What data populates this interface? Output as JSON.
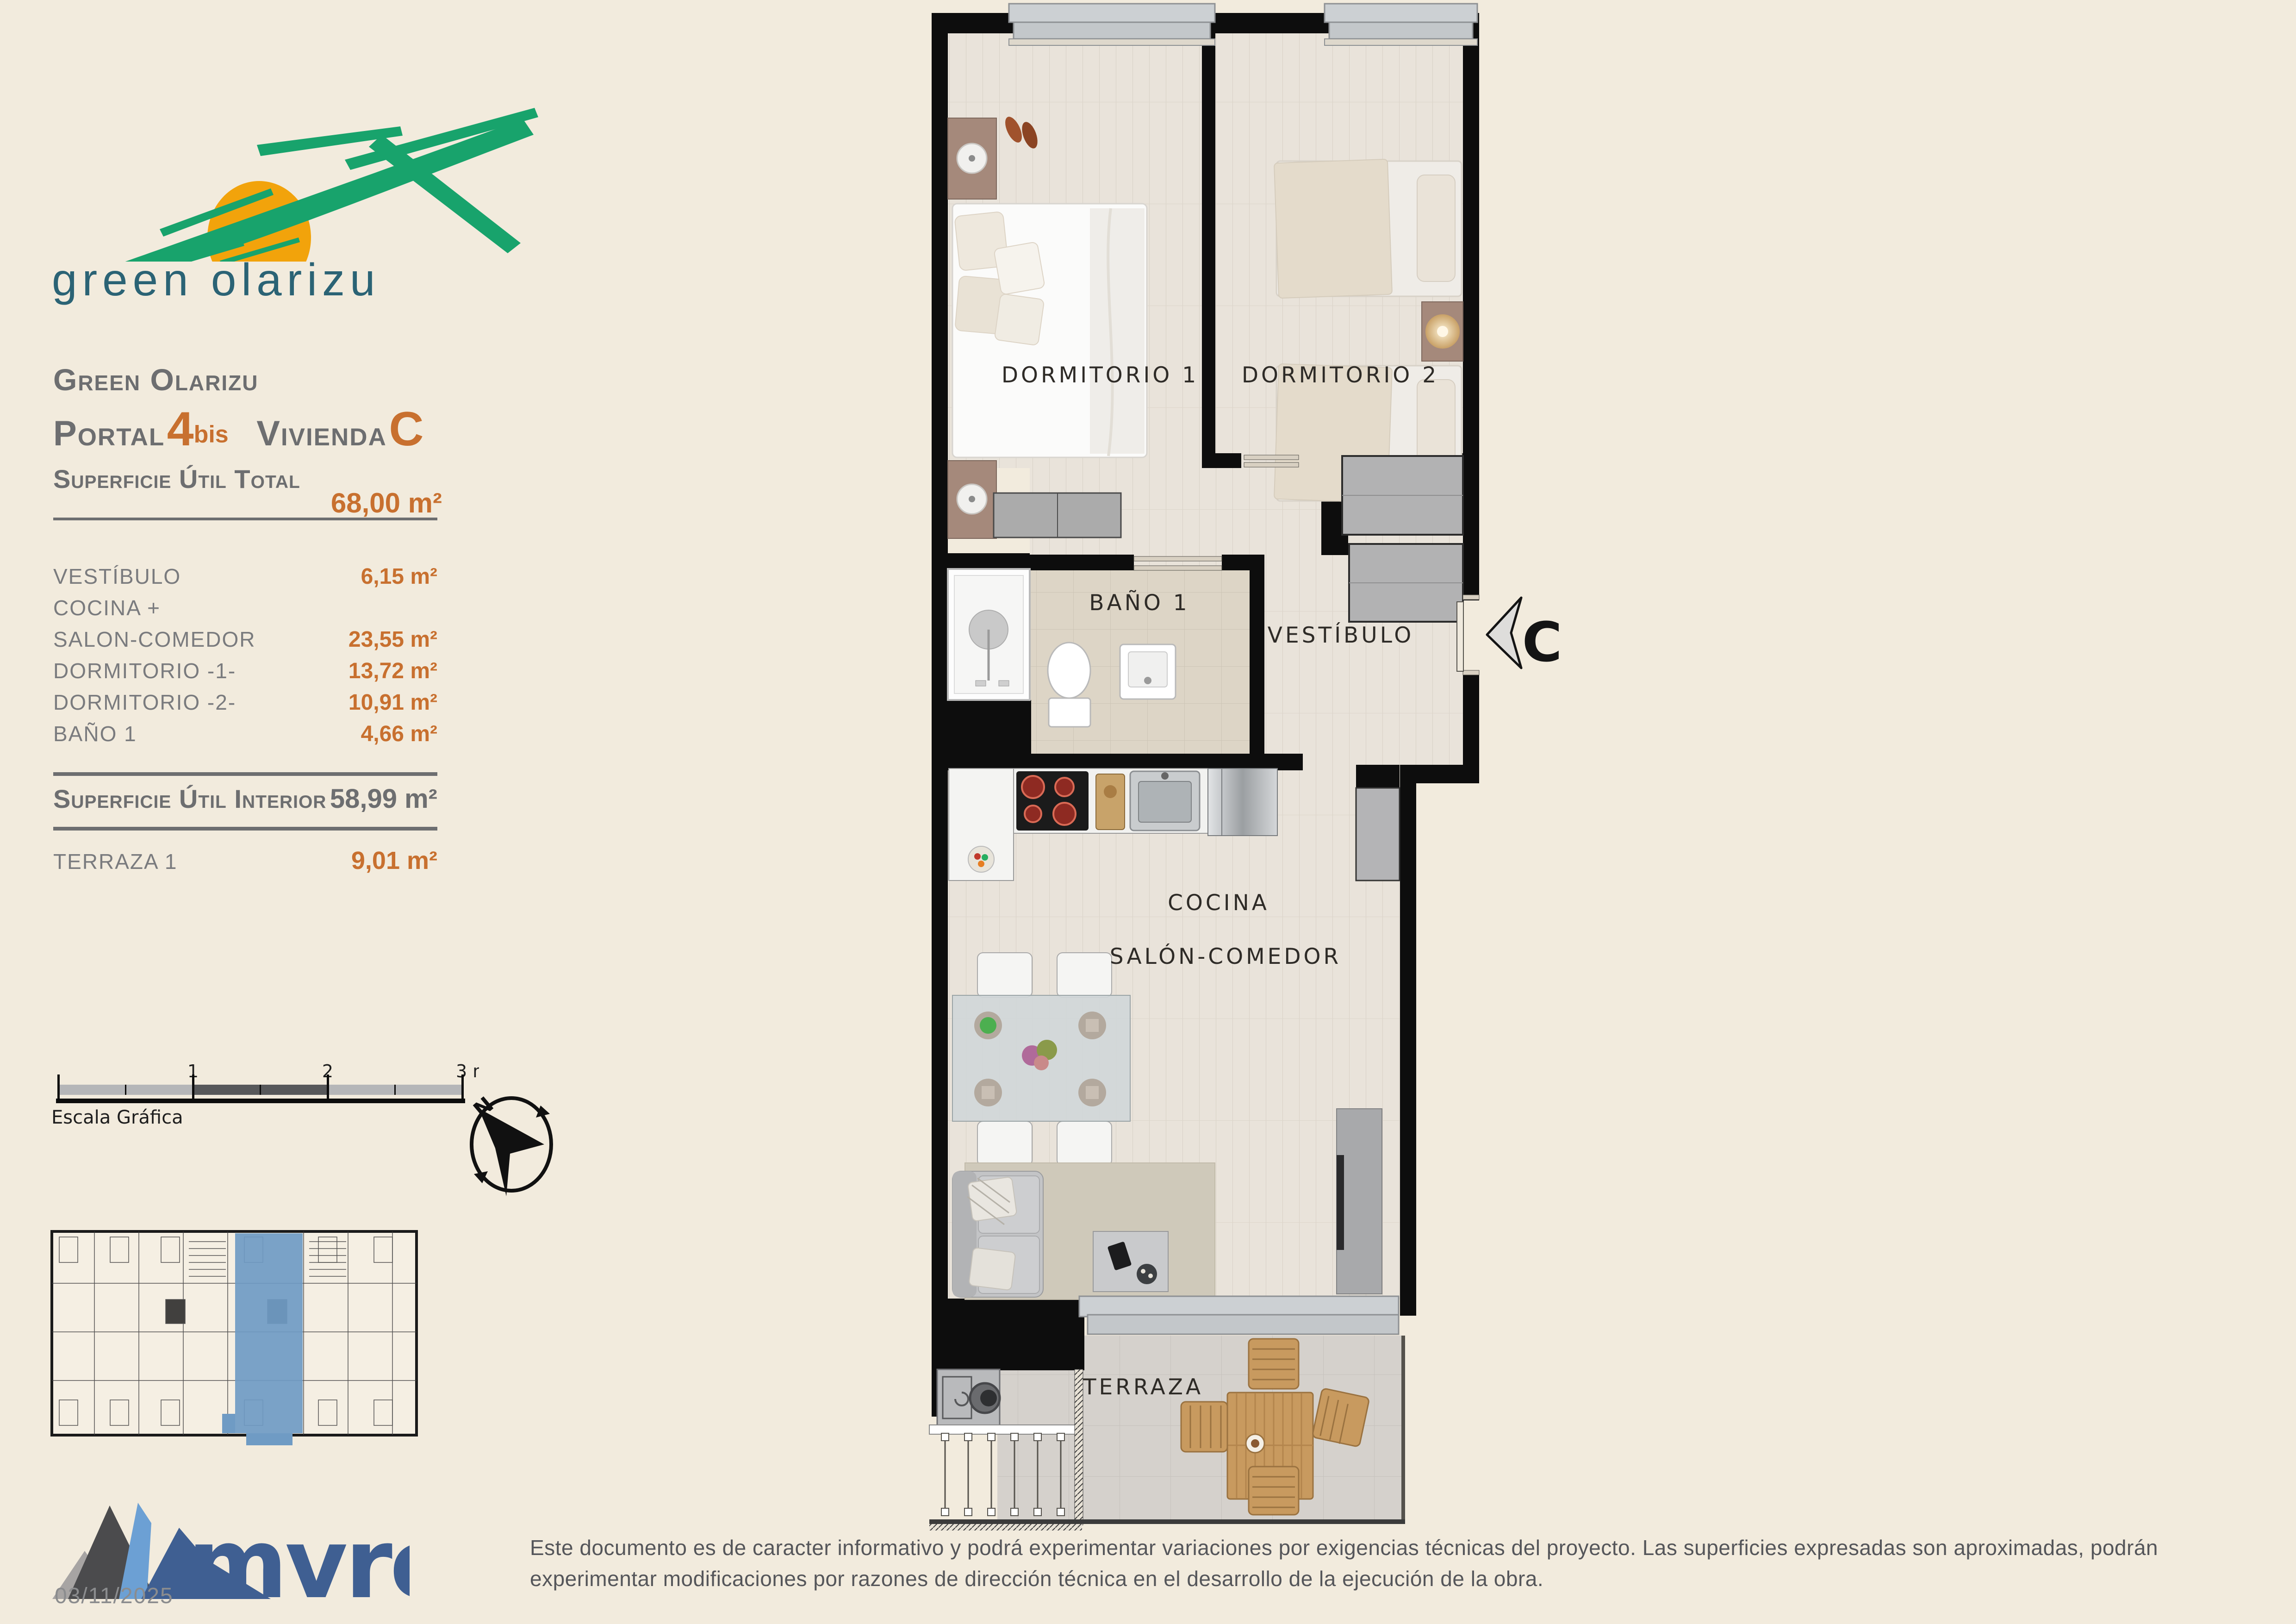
{
  "page": {
    "background": "#f2ebdd"
  },
  "logo": {
    "text": "green olarizu",
    "green": "#18a36c",
    "sun": "#f2a30b",
    "text_color": "#2b6375"
  },
  "header": {
    "project": "Green Olarizu",
    "portal_label": "Portal",
    "portal_number": "4",
    "portal_sup": "bis",
    "vivienda_label": "Vivienda",
    "vivienda_value": "C"
  },
  "surface": {
    "total_label": "Superficie Útil Total",
    "total_value": "68,00 m²",
    "rooms": [
      {
        "label": "VESTÍBULO",
        "value": "6,15 m²"
      },
      {
        "label": "COCINA +",
        "value": ""
      },
      {
        "label": "SALON-COMEDOR",
        "value": "23,55 m²"
      },
      {
        "label": "DORMITORIO -1-",
        "value": "13,72 m²"
      },
      {
        "label": "DORMITORIO -2-",
        "value": "10,91 m²"
      },
      {
        "label": "BAÑO 1",
        "value": "4,66 m²"
      }
    ],
    "interior_label": "Superficie Útil Interior",
    "interior_value": "58,99 m²",
    "terraza_label": "TERRAZA 1",
    "terraza_value": "9,01 m²"
  },
  "scalebar": {
    "one": "1",
    "two": "2",
    "three": "3 m.",
    "caption": "Escala Gráfica"
  },
  "compass": {
    "north": "N"
  },
  "plan": {
    "labels": {
      "dorm1": "DORMITORIO 1",
      "dorm2": "DORMITORIO 2",
      "bath": "BAÑO 1",
      "hall": "VESTÍBULO",
      "kitchen": "COCINA",
      "living": "SALÓN-COMEDOR",
      "terrace": "TERRAZA",
      "entry": "C"
    },
    "highlight": "#6f9bc4"
  },
  "footer": {
    "brand": "mvre",
    "brand_color": "#3f5f92",
    "date": "03/11/2025",
    "disclaimer": "Este documento es de caracter informativo y podrá experimentar variaciones por exigencias técnicas del proyecto. Las superficies expresadas son aproximadas, podrán experimentar modificaciones por razones de dirección técnica en el desarrollo de la ejecución de la obra."
  },
  "colors": {
    "accent_orange": "#c8702f",
    "heading_gray": "#6d6e70",
    "wall_black": "#0d0d0d"
  }
}
